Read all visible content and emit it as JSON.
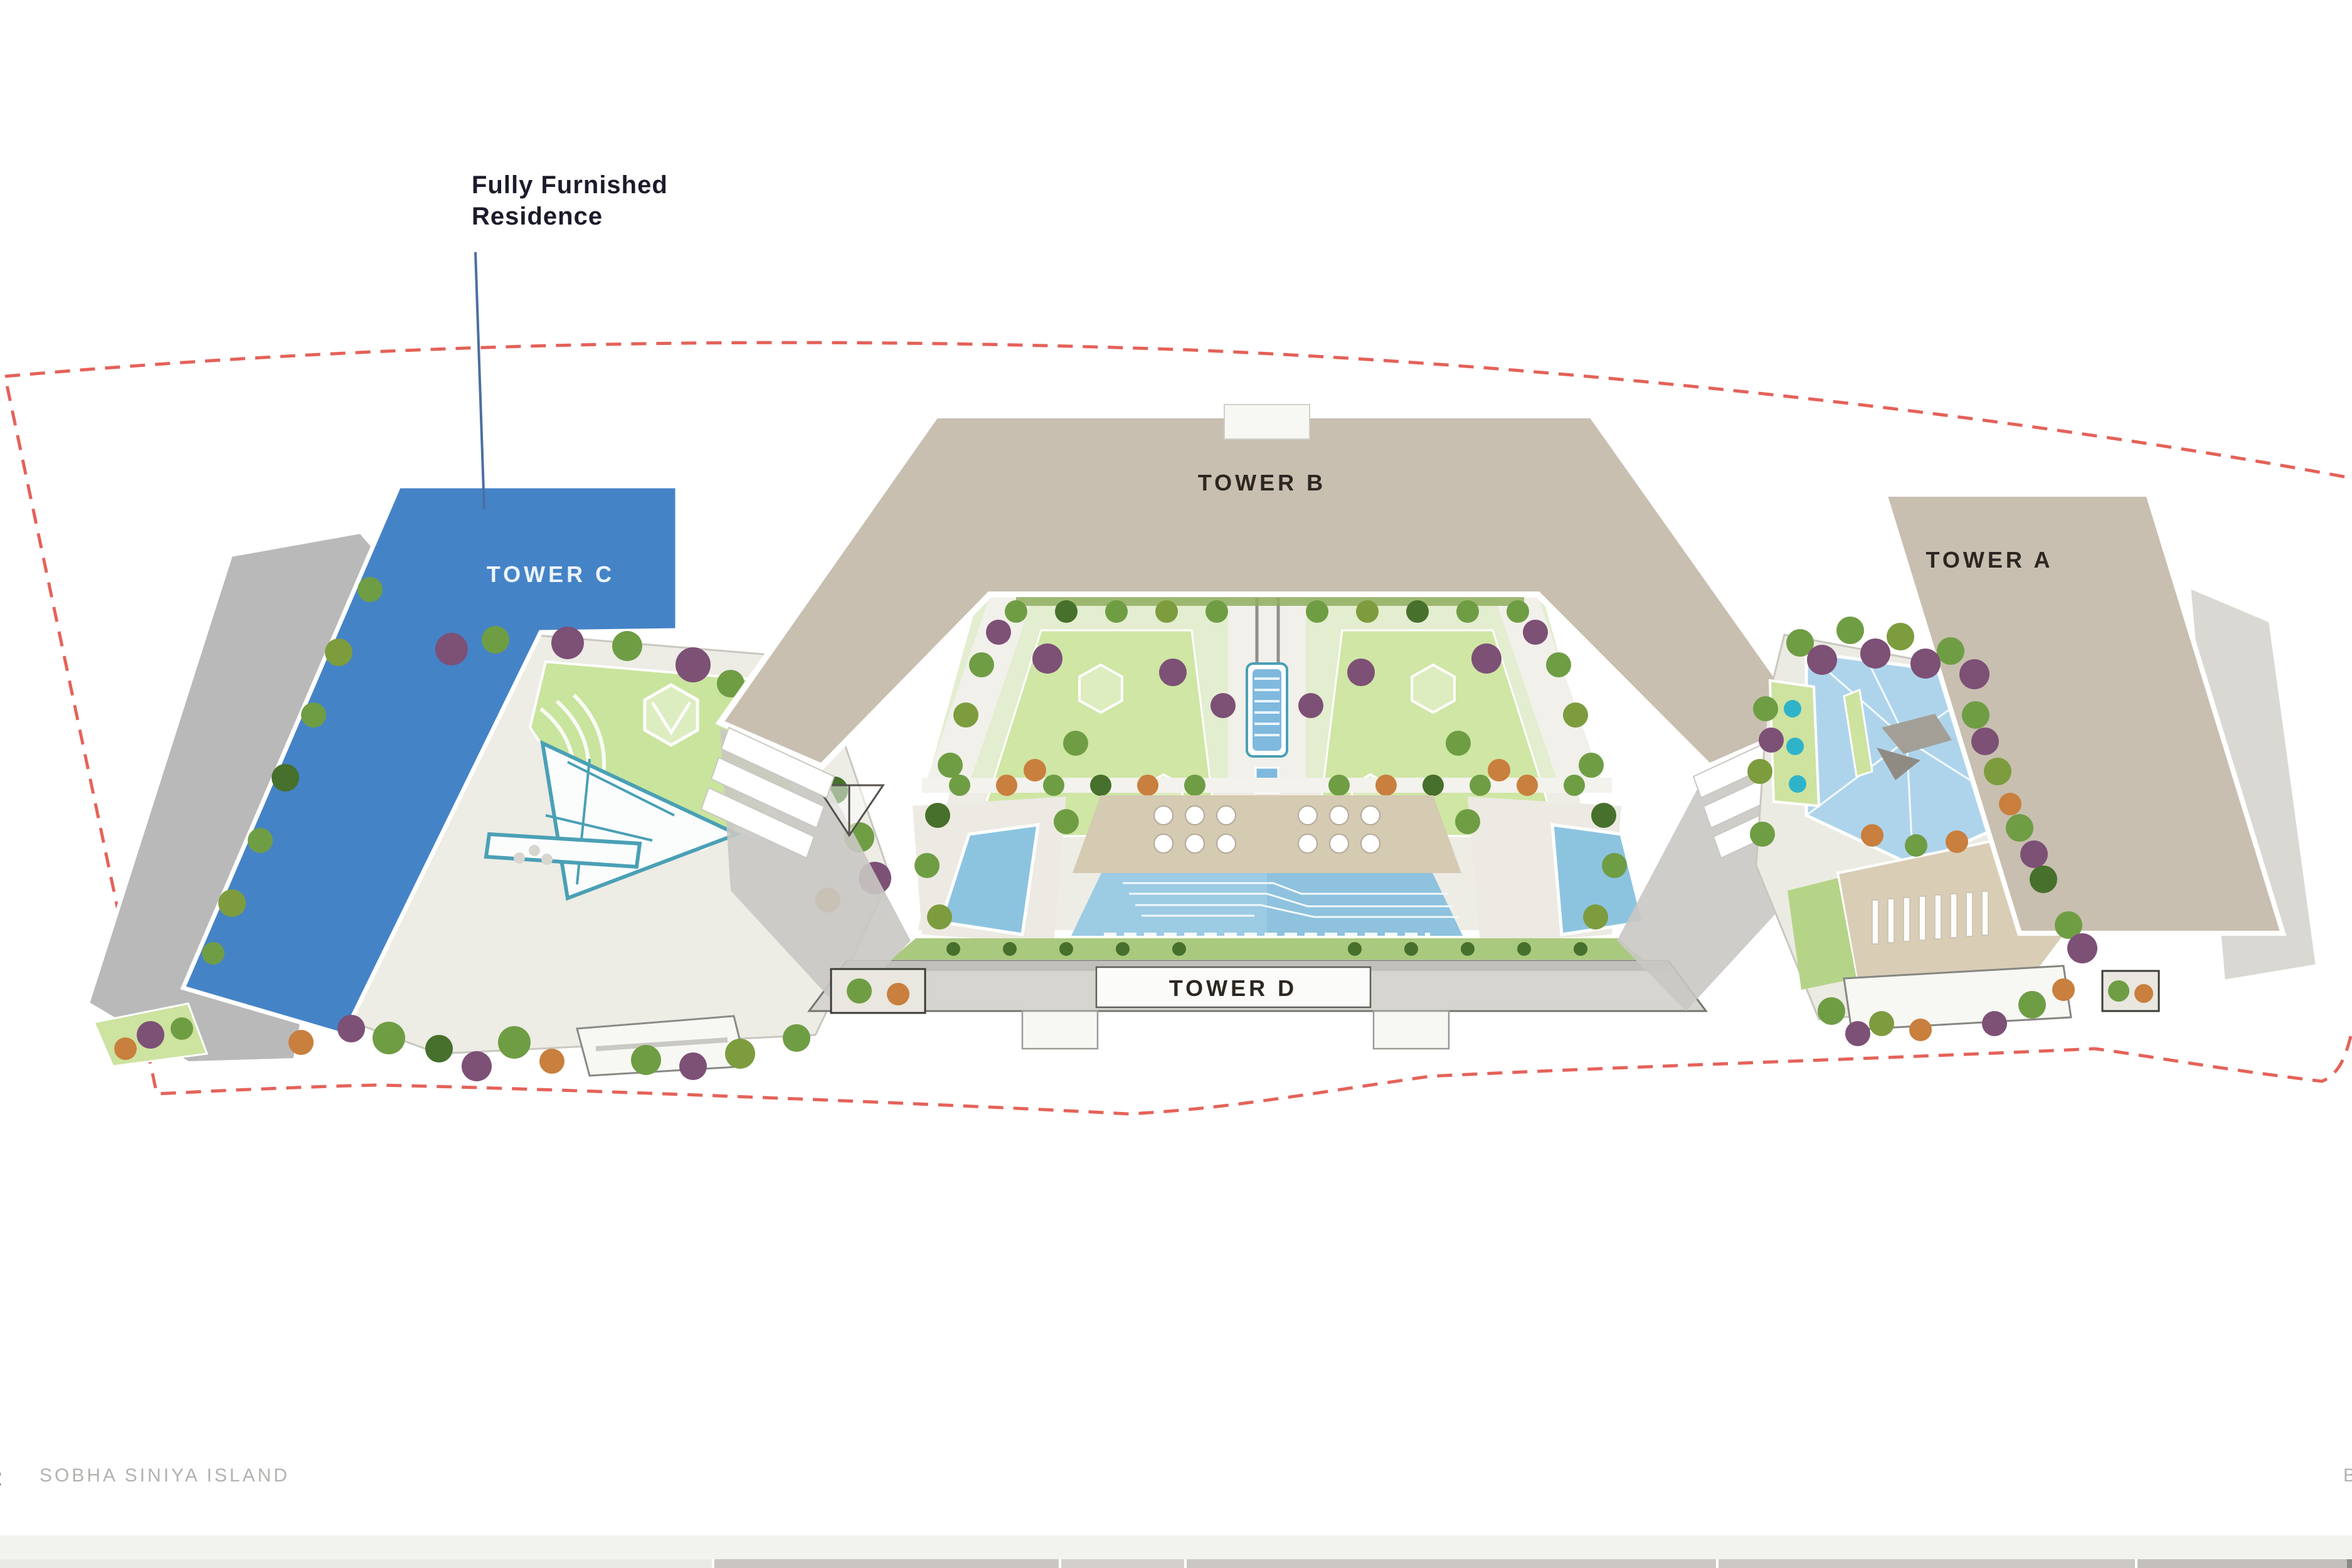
{
  "slide": {
    "type": "site-plan",
    "background": "#ffffff"
  },
  "annotation": {
    "line1": "Fully Furnished",
    "line2": "Residence",
    "leader_color": "#4a6fa0",
    "points_to": "TOWER C"
  },
  "towers": {
    "a": "TOWER A",
    "b": "TOWER B",
    "c": "TOWER C",
    "d": "TOWER D"
  },
  "highlight": {
    "label": "TOWER C",
    "color": "#4583c7",
    "meaning": "Fully Furnished Residence"
  },
  "boundary": {
    "color": "#e0463c",
    "style": "dashed"
  },
  "footer": {
    "project": "SOBHA SINIYA ISLAND",
    "page_number_partial": "2",
    "right_partial": "B"
  },
  "colors": {
    "building_beige": "#c8bfb0",
    "building_gray_shadow": "#b9b9b9",
    "tower_c_blue": "#4583c7",
    "courtyard_paving": "#edece5",
    "lawn_green": "#c9e49d",
    "pool_blue": "#9ccbe4",
    "canal_blue": "#7fb9dd",
    "deck_tan": "#d5cab2",
    "tree_green": "#6f9d44",
    "tree_purple": "#7d5076",
    "tree_orange": "#c97f3d",
    "boundary_red": "#e0463c",
    "footer_band": "#f2f2ef"
  }
}
